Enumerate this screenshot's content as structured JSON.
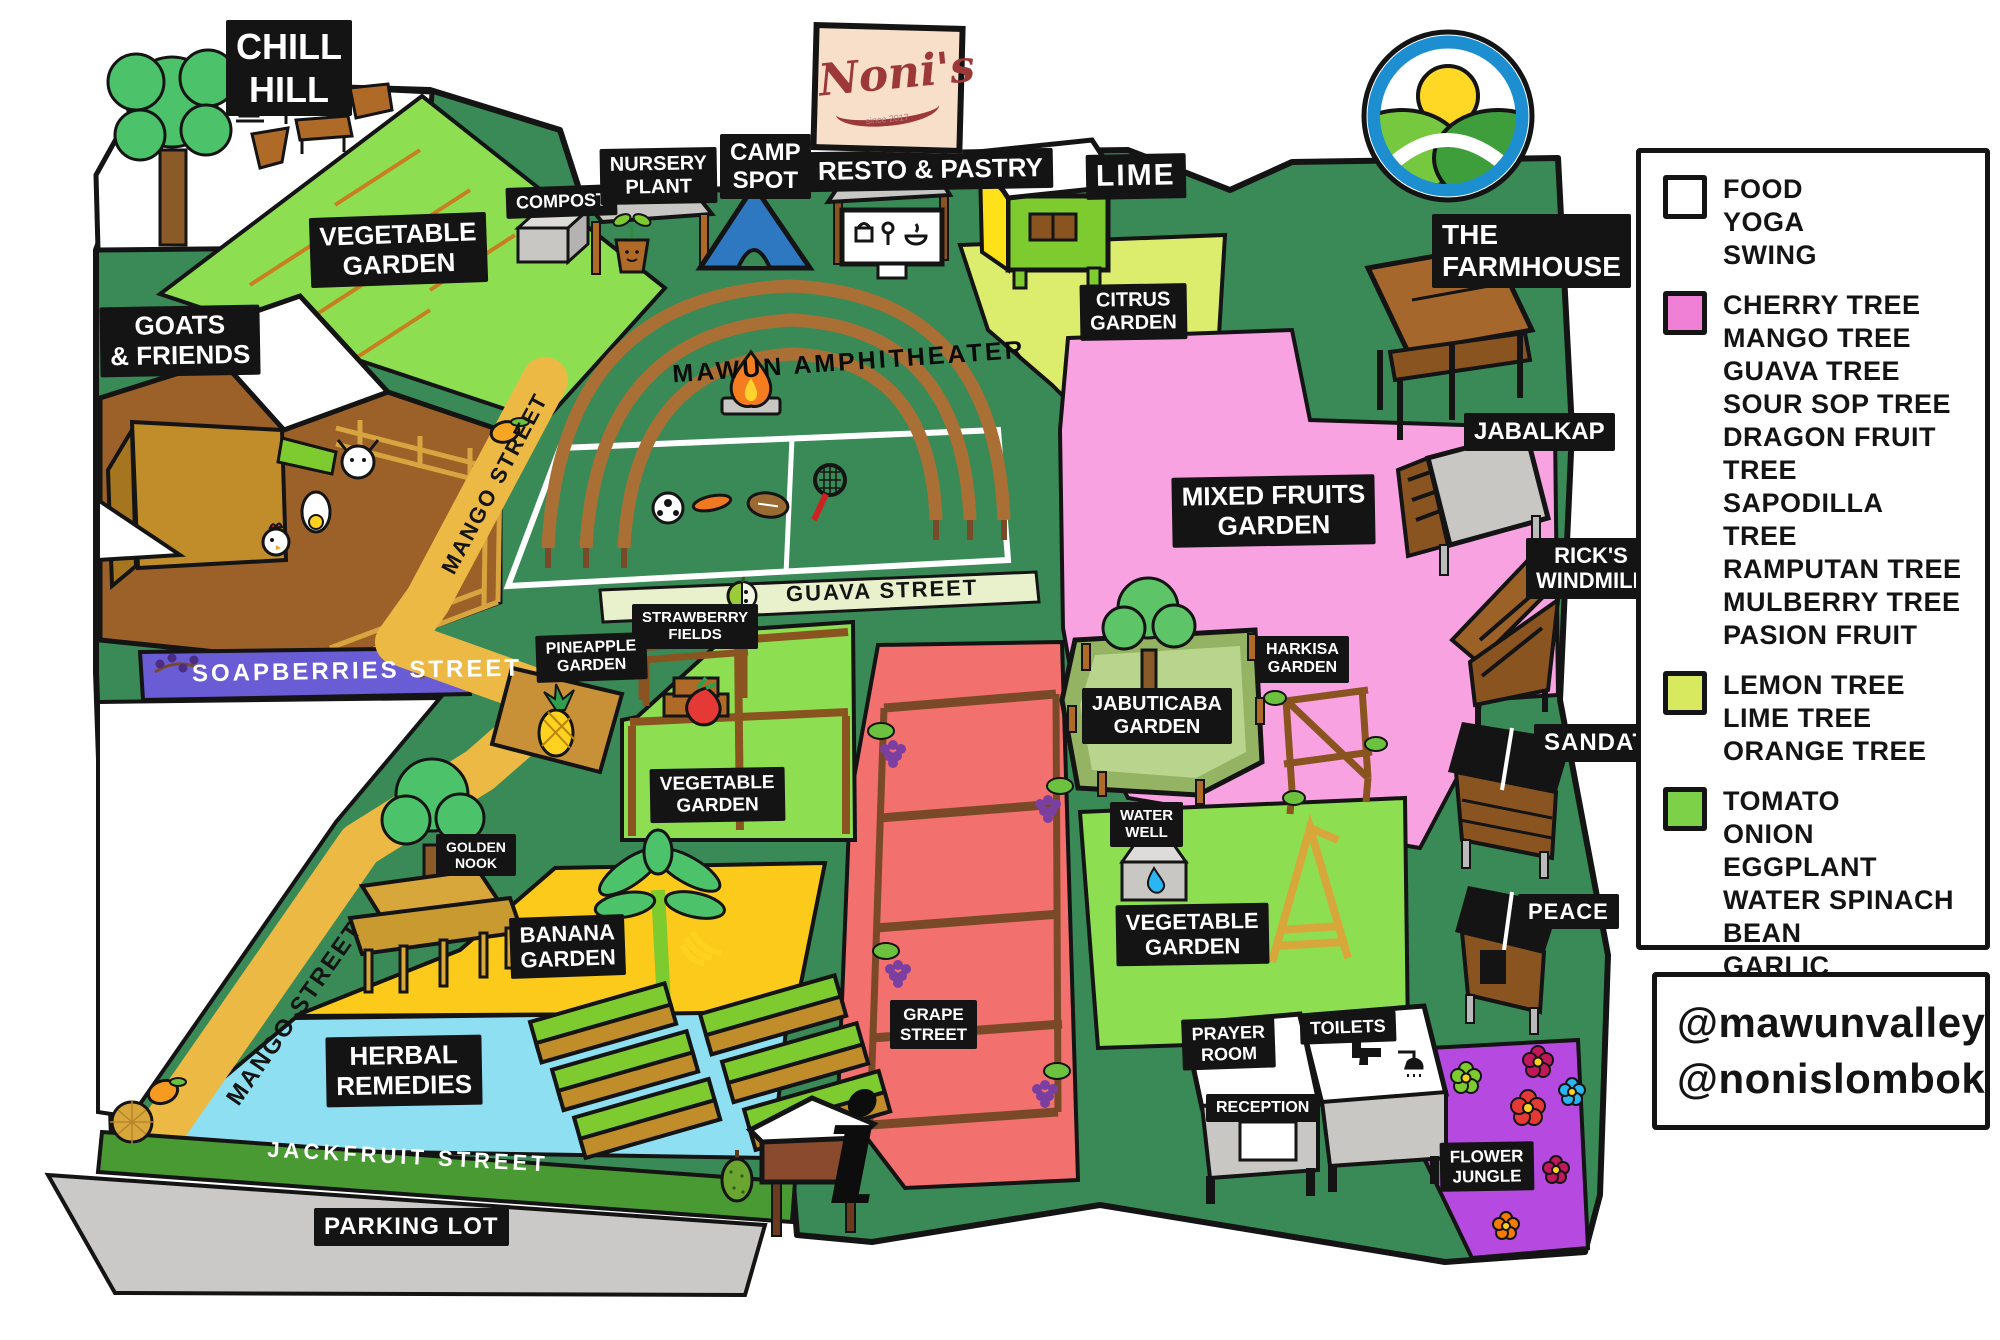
{
  "brand": {
    "name": "Noni's",
    "since": "since 2017"
  },
  "map": {
    "labels": {
      "chill_hill": "CHILL\nHILL",
      "vegetable_garden_nw": "VEGETABLE\nGARDEN",
      "goats_friends": "GOATS\n& FRIENDS",
      "compost": "COMPOST",
      "nursery_plant": "NURSERY\nPLANT",
      "camp_spot": "CAMP\nSPOT",
      "resto_pastry": "RESTO & PASTRY",
      "lime": "LIME",
      "citrus_garden": "CITRUS\nGARDEN",
      "farmhouse": "THE\nFARMHOUSE",
      "amphitheater": "MAWUN AMPHITHEATER",
      "mango_street_upper": "MANGO STREET",
      "mango_street_lower": "MANGO STREET",
      "guava_street": "GUAVA STREET",
      "soapberries_street": "SOAPBERRIES STREET",
      "mixed_fruits_garden": "MIXED FRUITS\nGARDEN",
      "jabalkap": "JABALKAP",
      "ricks_windmill": "RICK'S\nWINDMILL",
      "strawberry_fields": "STRAWBERRY\nFIELDS",
      "pineapple_garden": "PINEAPPLE\nGARDEN",
      "vegetable_garden_mid": "VEGETABLE\nGARDEN",
      "jabuticaba_garden": "JABUTICABA\nGARDEN",
      "harkisa_garden": "HARKISA\nGARDEN",
      "sandat": "SANDAT",
      "golden_nook": "GOLDEN\nNOOK",
      "banana_garden": "BANANA\nGARDEN",
      "water_well": "WATER\nWELL",
      "vegetable_garden_se": "VEGETABLE\nGARDEN",
      "peace": "PEACE",
      "herbal_remedies": "HERBAL\nREMEDIES",
      "grape_street": "GRAPE\nSTREET",
      "prayer_room": "PRAYER\nROOM",
      "reception": "RECEPTION",
      "toilets": "TOILETS",
      "flower_jungle": "FLOWER\nJUNGLE",
      "jackfruit_street": "JACKFRUIT STREET",
      "parking_lot": "PARKING LOT"
    }
  },
  "legend": {
    "groups": [
      {
        "color": "#ffffff",
        "items": [
          "FOOD",
          "YOGA",
          "SWING"
        ]
      },
      {
        "color": "#f07fd6",
        "items": [
          "CHERRY TREE",
          "MANGO TREE",
          "GUAVA TREE",
          "SOUR SOP TREE",
          "DRAGON FRUIT TREE",
          "SAPODILLA TREE",
          "RAMPUTAN TREE",
          "MULBERRY TREE",
          "PASION FRUIT"
        ]
      },
      {
        "color": "#d8e95f",
        "items": [
          "LEMON TREE",
          "LIME TREE",
          "ORANGE TREE"
        ]
      },
      {
        "color": "#7cd148",
        "items": [
          "TOMATO",
          "ONION",
          "EGGPLANT",
          "WATER SPINACH",
          "BEAN",
          "GARLIC"
        ]
      }
    ]
  },
  "social": {
    "handle1": "@mawunvalley",
    "handle2": "@nonislombok"
  },
  "landmarks": {
    "info_symbol": "i"
  },
  "colors": {
    "grass": "#3a8a57",
    "veg_light": "#8ede52",
    "citrus": "#dcec6c",
    "mixed_fruits_pink": "#f9a2e2",
    "grape_red": "#f2706d",
    "banana_yellow": "#fbca1b",
    "herbal_blue": "#8edff1",
    "flower_purple": "#b64ae0",
    "soapberries_purple": "#6a5cd5",
    "mango_road": "#ecb944",
    "guava_road": "#e8f0cc",
    "jackfruit_road": "#4a9a34",
    "parking_gray": "#cbc9c7",
    "pen_brown": "#9c6128",
    "jabuticaba_olive": "#94b363"
  }
}
